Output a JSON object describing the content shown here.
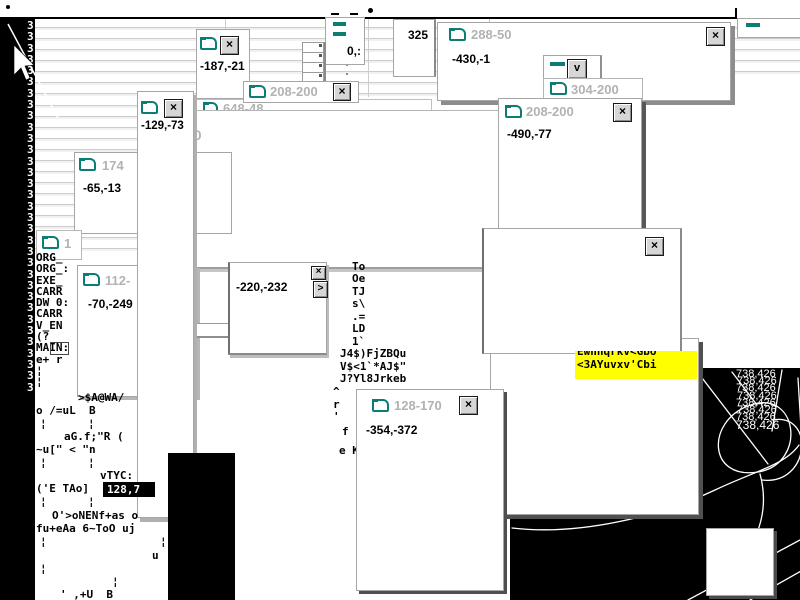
{
  "glyphs": {
    "close": "×",
    "dropdown": "v",
    "arrow_right": ">"
  },
  "colors": {
    "teal": "#0a7e74",
    "highlight_bg": "#ffff00",
    "title_gray": "#b2b2b2"
  },
  "windows": {
    "w187": {
      "content": "-187,-21"
    },
    "w208a": {
      "title": "208-200"
    },
    "w648": {
      "title": "648-48"
    },
    "w20": {
      "title": "20"
    },
    "w288": {
      "title": "288-50",
      "content": "-430,-1"
    },
    "w304": {
      "title": "304-200"
    },
    "w208b": {
      "title": "208-200",
      "content": "-490,-77"
    },
    "w174": {
      "title": "174",
      "content": "-65,-13"
    },
    "w1": {
      "title": "1"
    },
    "w112": {
      "title": "112-",
      "content": "-70,-249"
    },
    "w220": {
      "content": "-220,-232"
    },
    "wtall": {
      "content": "-129,-73"
    },
    "w128": {
      "title": "128-170",
      "content": "-354,-372"
    },
    "w325": {
      "content": "325"
    },
    "w0frag": {
      "content": "0,:"
    }
  },
  "highlight": {
    "line1": "Ewnnqrkv<Gbo",
    "line2": "<3AYuvxv'Cbi"
  },
  "left_glyph_column": "3\n3\n3\n3\n3\n3\n3\n3\n3\n3\n3\n3\n3\n3\n3\n3\n3\n3\n3\n3\n3\n3\n3\n3\n3\n3\n3\n3\n3\n3\n3\n3\n3",
  "garble_org": "ORG_\nORG_:\nEXE_\nCARR\nDW 0:\nCARR\nV_EN\n(?\nMAIN:\ne+ r\n¦\n¦",
  "garble_left": [
    ">$A@WA/",
    "o /=uL  B",
    "¦",
    "¦",
    "aG.f;\"R (",
    "~u[\" < \"n",
    "¦",
    "¦",
    "vTYC:",
    "('E TAo]",
    "¦",
    "¦",
    "O'>oNENf+as o",
    "fu+eAa 6~ToO uj",
    "¦",
    "¦",
    "u",
    "¦",
    "¦",
    "' ,+U  B"
  ],
  "selected_coord": "128,7",
  "garble_center": [
    "To",
    "Oe",
    "TJ",
    "s\\",
    ".=",
    "LD",
    "1`",
    "J4$)FjZBQu",
    "V$<1`*AJ$\"",
    "J?Yl8Jrkeb",
    "^",
    "r",
    "'",
    "f",
    "e K"
  ],
  "black_panel": {
    "coord_text": "738,426"
  }
}
